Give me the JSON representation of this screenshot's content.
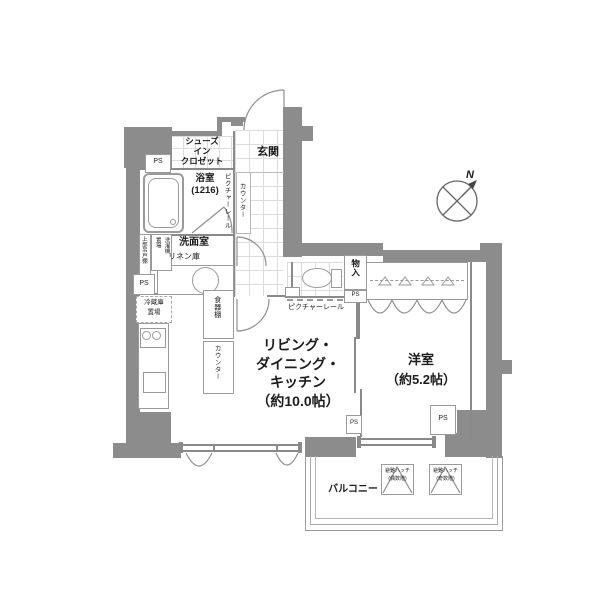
{
  "rooms": {
    "entrance": "玄関",
    "shoes_closet": "シューズ\nイン\nクロゼット",
    "bathroom": "浴室\n(1216)",
    "washroom": "洗面室",
    "linen": "リネン庫",
    "ldk": "リビング・\nダイニング・\nキッチン\n（約10.0帖）",
    "western_room": "洋室\n（約5.2帖）",
    "balcony": "バルコニー",
    "storage": "物入"
  },
  "labels": {
    "ps": "PS",
    "picture_rail": "ピクチャーレール",
    "counter": "カウンター",
    "cupboard": "食器棚",
    "refrigerator_space": "冷蔵庫\n置場",
    "washer_space": "洗濯機\n置場",
    "upper_cabinet": "上部吊戸棚",
    "hatch_left": "避難ハッチ\n(偶数階)",
    "hatch_right": "避難ハッチ\n(奇数階)",
    "north": "N"
  },
  "colors": {
    "wall": "#8c8c8c",
    "line": "#8a8a8a",
    "text": "#1c1c1c"
  }
}
